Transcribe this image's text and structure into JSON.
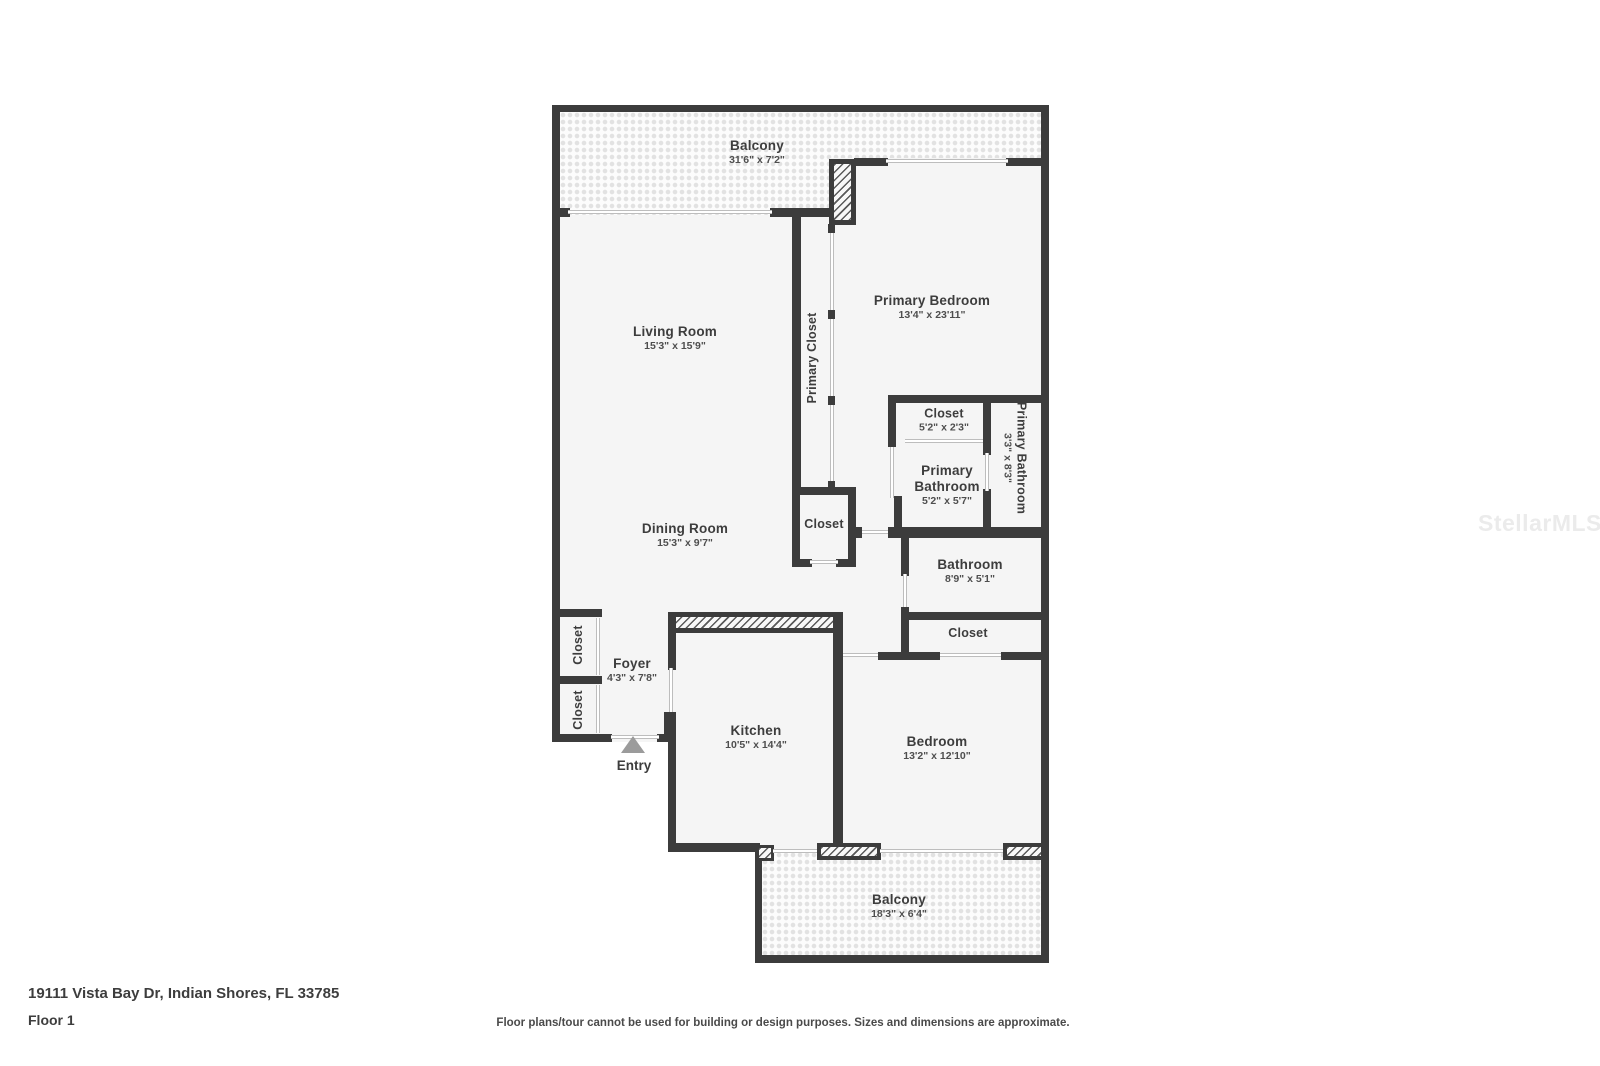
{
  "meta": {
    "address": "19111 Vista Bay Dr, Indian Shores, FL 33785",
    "floor": "Floor 1",
    "disclaimer": "Floor plans/tour cannot be used for building or design purposes. Sizes and dimensions are approximate.",
    "watermark": "StellarMLS"
  },
  "colors": {
    "wall": "#3c3c3c",
    "room_fill": "#f5f5f5",
    "label_text": "#3d3d3d",
    "entry_arrow": "#9b9b9b"
  },
  "rooms": {
    "balcony_top": {
      "label": "Balcony",
      "dims": "31'6\" x 7'2\""
    },
    "living_room": {
      "label": "Living Room",
      "dims": "15'3\" x 15'9\""
    },
    "primary_bedroom": {
      "label": "Primary Bedroom",
      "dims": "13'4\" x 23'11\""
    },
    "primary_closet": {
      "label": "Primary Closet"
    },
    "closet_primary": {
      "label": "Closet",
      "dims": "5'2\" x 2'3\""
    },
    "primary_bathroom": {
      "label": "Primary Bathroom",
      "dims": "5'2\" x 5'7\""
    },
    "primary_bathroom_2": {
      "label": "Primary Bathroom",
      "dims": "3'3\" x 8'3\""
    },
    "dining_room": {
      "label": "Dining Room",
      "dims": "15'3\" x 9'7\""
    },
    "closet_hall": {
      "label": "Closet"
    },
    "bathroom": {
      "label": "Bathroom",
      "dims": "8'9\" x 5'1\""
    },
    "closet_bath": {
      "label": "Closet"
    },
    "foyer": {
      "label": "Foyer",
      "dims": "4'3\" x 7'8\""
    },
    "closet_foyer_1": {
      "label": "Closet"
    },
    "closet_foyer_2": {
      "label": "Closet"
    },
    "kitchen": {
      "label": "Kitchen",
      "dims": "10'5\" x 14'4\""
    },
    "bedroom": {
      "label": "Bedroom",
      "dims": "13'2\" x 12'10\""
    },
    "balcony_bottom": {
      "label": "Balcony",
      "dims": "18'3\" x 6'4\""
    },
    "entry": {
      "label": "Entry"
    }
  }
}
